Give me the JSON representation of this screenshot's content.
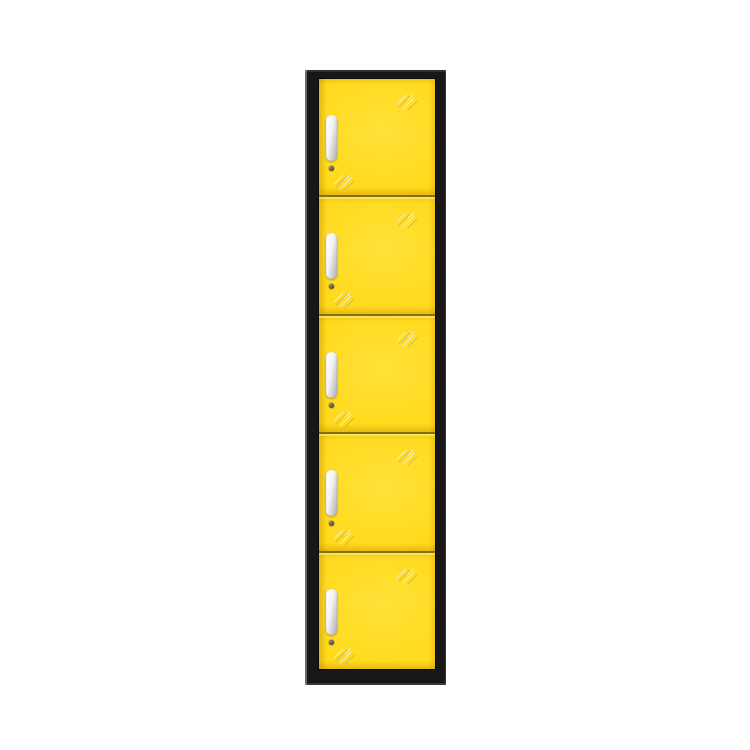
{
  "image": {
    "type": "product-photo",
    "subject": "tall narrow 5-door steel locker cabinet, yellow doors with black frame"
  },
  "locker": {
    "door_count": 5,
    "colors": {
      "background": "#ffffff",
      "frame": "#17171a",
      "door": "#ffd917",
      "separator": "#85700a",
      "handle-light": "#ffffff",
      "handle-dark": "#b0b0b0",
      "lock": "#3d4046",
      "glint-light": "#f2ecd2",
      "glint-dark": "#a79d72"
    },
    "doors": [
      {
        "id": "locker-door-1",
        "handle": "vertical-pull-handle",
        "lock": "round-cam-lock"
      },
      {
        "id": "locker-door-2",
        "handle": "vertical-pull-handle",
        "lock": "round-cam-lock"
      },
      {
        "id": "locker-door-3",
        "handle": "vertical-pull-handle",
        "lock": "round-cam-lock"
      },
      {
        "id": "locker-door-4",
        "handle": "vertical-pull-handle",
        "lock": "round-cam-lock"
      },
      {
        "id": "locker-door-5",
        "handle": "vertical-pull-handle",
        "lock": "round-cam-lock"
      }
    ]
  }
}
